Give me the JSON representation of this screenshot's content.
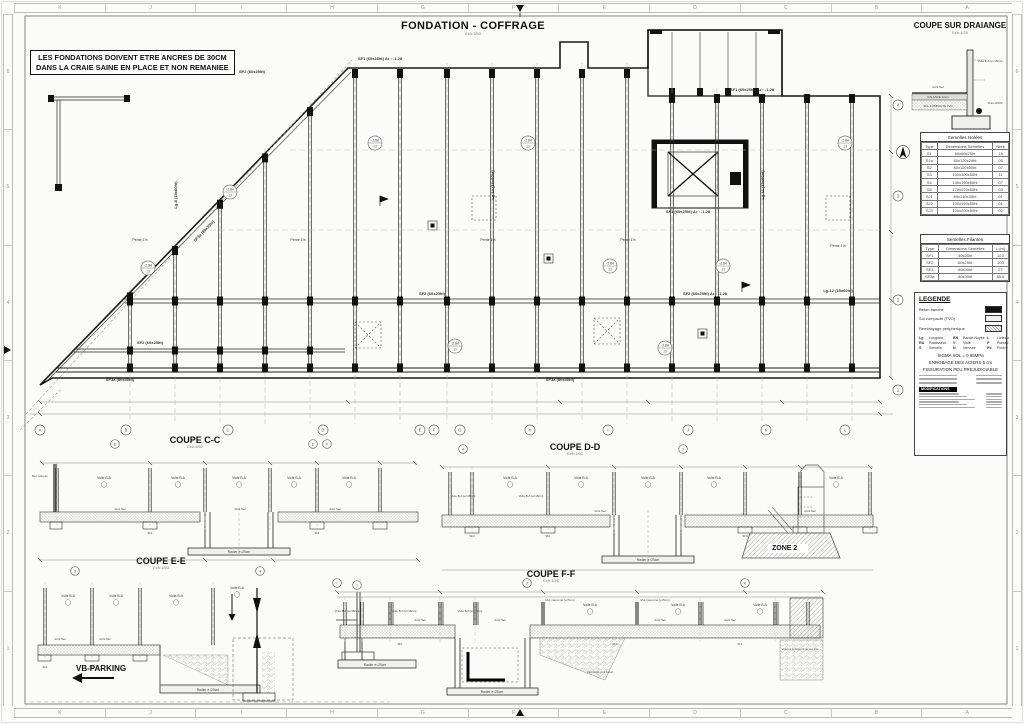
{
  "sheet": {
    "title": "FONDATION - COFFRAGE",
    "title_scale": "Ech:1/50",
    "note_line1": "LES FONDATIONS DOIVENT ETRE ANCRES DE 30CM",
    "note_line2": "DANS LA CRAIE SAINE  EN PLACE ET NON REMANIEE"
  },
  "rulers": {
    "top_letters": [
      "K",
      "J",
      "I",
      "H",
      "G",
      "F",
      "E",
      "D",
      "C",
      "B",
      "A"
    ],
    "bottom_letters": [
      "K",
      "J",
      "I",
      "H",
      "G",
      "F",
      "E",
      "D",
      "C",
      "B",
      "A"
    ],
    "left_numbers": [
      "6",
      "5",
      "4",
      "3",
      "2",
      "1"
    ],
    "right_numbers": [
      "6",
      "5",
      "4",
      "3",
      "2",
      "1"
    ]
  },
  "plan": {
    "bottom_bubbles": [
      "A",
      "B",
      "C",
      "D",
      "E",
      "F",
      "G",
      "H",
      "I",
      "J",
      "K",
      "L"
    ],
    "right_bubbles": [
      "4",
      "3",
      "2",
      "1"
    ],
    "level_marker": "-2.84",
    "level_marker_sub": "13",
    "labels": {
      "sf1": "SF1 (60x25ht)  Ar : -1.28",
      "sf2": "SF2 (60x25ht)",
      "sf2b": "SF2 (60x25ht)  Ar : -1.28",
      "sf3a": "SF3a (80x30ht)",
      "lg8": "Lg-8 (15x60ht)",
      "lg10": "Lg-10 (15x60ht)",
      "lg11": "Lg-11 (15x60ht)",
      "lg12": "Lg-12 (15x60ht)",
      "pente": "Pente 1%"
    }
  },
  "sections": {
    "cc": {
      "title": "COUPE C-C",
      "scale": "Ech:1/50",
      "bubbles": [
        "D",
        "E",
        "F"
      ]
    },
    "dd": {
      "title": "COUPE D-D",
      "scale": "Ech:1/50",
      "bubbles": [
        "4",
        "3"
      ]
    },
    "ee": {
      "title": "COUPE E-E",
      "scale": "Ech:1/50",
      "bubbles": [
        "3",
        "4",
        "1"
      ]
    },
    "ff": {
      "title": "COUPE F-F",
      "scale": "Ech:1/25",
      "bubbles": [
        "I",
        "J",
        "K"
      ]
    },
    "drain": {
      "title": "COUPE SUR DRAIANGE",
      "scale": "Ech:1/25"
    },
    "labels": {
      "voile": "Voile B.A",
      "voile_e": "Voile B.A (e=18cm)",
      "joint": "Joint Sec",
      "radier": "Radier e=25cm",
      "mur_mit": "Mur mitoyen",
      "mur_mac": "Mur maçonné (e=5cm)",
      "remblais": "Remblais gros béton",
      "volume": "Volume à déterminer sur site",
      "drain": "Drain Ø100",
      "dallage": "DALLAGE 12cm",
      "sol": "SOL COMPACTE TVO",
      "parking": "VB-PARKING",
      "zone2": "ZONE 2",
      "sf1": "SF1",
      "sf2": "SF2",
      "sf3": "SF3"
    }
  },
  "tables": {
    "isolees": {
      "title": "Semelles Isolées",
      "headers": [
        "Type",
        "Dimensions Semelles",
        "Nbre"
      ],
      "rows": [
        [
          "S1",
          "60x60x25ht",
          "18"
        ],
        [
          "S1a",
          "80x120x25ht",
          "05"
        ],
        [
          "S2",
          "80x120x50ht",
          "07"
        ],
        [
          "S3",
          "100x100x50ht",
          "11"
        ],
        [
          "S4",
          "140x190x50ht",
          "07"
        ],
        [
          "S5",
          "170x170x50ht",
          "03"
        ],
        [
          "SJ1",
          "80x140x35ht",
          "01"
        ],
        [
          "SJ2",
          "100x190x50ht",
          "01"
        ],
        [
          "SJ3",
          "100x200x50ht",
          "02"
        ]
      ]
    },
    "filantes": {
      "title": "Semelles Filantes",
      "headers": [
        "Type",
        "Dimensions Semelles",
        "L (m)"
      ],
      "rows": [
        [
          "SF1",
          "40x25ht",
          "123"
        ],
        [
          "SF2",
          "60x25ht",
          "103"
        ],
        [
          "SF3",
          "80x30ht",
          "27"
        ],
        [
          "SF3a",
          "80x30ht",
          "85.5"
        ]
      ]
    }
  },
  "legend": {
    "title": "LEGENDE",
    "swatch_solid": "Béton banché",
    "swatch_light": "Sol compacté (TVO)",
    "swatch_hatch": "Remblayage périphérique",
    "abbreviations": [
      [
        "Lg",
        "Longrine"
      ],
      [
        "BN",
        "Bande Noyée"
      ],
      [
        "L",
        "Linteau"
      ],
      [
        "RA",
        "Raidisseur"
      ],
      [
        "V",
        "Voile"
      ],
      [
        "P",
        "Poteau"
      ],
      [
        "S",
        "Semelle"
      ],
      [
        "N",
        "Nervure"
      ],
      [
        "Po",
        "Poutre"
      ]
    ],
    "notes": [
      "SIGMA SOL = 0.65MPa",
      "ENROBAGE DES ACIERS  5 cm",
      "FISSURATION PEU PREJUDICIABLE"
    ],
    "modifications_title": "MODIFICATIONS"
  }
}
